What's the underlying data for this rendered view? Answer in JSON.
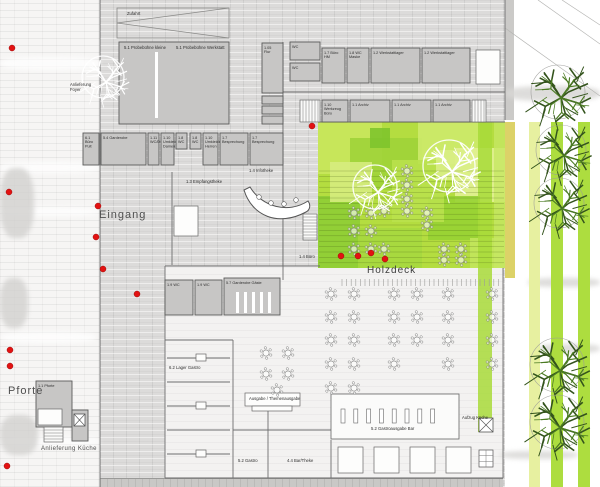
{
  "labels": {
    "eingang": "Eingang",
    "holzdeck": "Holzdeck",
    "pforte": "Pforte",
    "anlieferung_kueche": "Anlieferung Küche"
  },
  "colors": {
    "deck_base": "#b4dd40",
    "stripe_green": "#addd3f",
    "stripe_yellow": "#e7f0a0",
    "stripe_olive": "#d8cd58",
    "red_dot": "#e31212",
    "tree_green": "#33531c",
    "room_fill": "#c7c6c5",
    "wall": "#6e6e6e"
  },
  "rooms": [
    [
      "",
      119,
      42,
      110,
      82
    ],
    [
      "1.05 Flur",
      262,
      43,
      21,
      50
    ],
    [
      "",
      262,
      96,
      21,
      8
    ],
    [
      "",
      262,
      106,
      21,
      8
    ],
    [
      "",
      262,
      116,
      21,
      8
    ],
    [
      "WC",
      290,
      42,
      30,
      18
    ],
    [
      "WC",
      290,
      63,
      30,
      18
    ],
    [
      "1.7 Büro HM",
      322,
      48,
      23,
      35
    ],
    [
      "1.8 WC Maske",
      347,
      48,
      22,
      35
    ],
    [
      "1.2 Werkstattlager",
      371,
      48,
      49,
      35
    ],
    [
      "1.2 Werkstattlager",
      422,
      48,
      48,
      35
    ],
    [
      "1.10 Werkzeug Büro",
      322,
      100,
      26,
      22
    ],
    [
      "1.1 Archiv",
      350,
      100,
      40,
      22
    ],
    [
      "1.1 Archiv",
      392,
      100,
      39,
      22
    ],
    [
      "1.1 Archiv",
      433,
      100,
      37,
      22
    ],
    [
      "6.1 Büro Pult",
      83,
      133,
      16,
      32
    ],
    [
      "5.4 Garderobe",
      101,
      133,
      45,
      32
    ],
    [
      "1.11 WC/Du",
      148,
      133,
      11,
      32
    ],
    [
      "1.10 Umkleide Damen",
      161,
      133,
      13,
      32
    ],
    [
      "1.8 WC",
      176,
      133,
      11,
      16
    ],
    [
      "1.8 WC",
      190,
      133,
      11,
      16
    ],
    [
      "1.10 Umkleide Herren",
      203,
      133,
      15,
      32
    ],
    [
      "1.7 Besprechung",
      220,
      133,
      28,
      32
    ],
    [
      "1.7 Besprechung",
      250,
      133,
      33,
      32
    ],
    [
      "1.9 WC",
      165,
      280,
      28,
      35
    ],
    [
      "1.9 WC",
      195,
      280,
      27,
      35
    ],
    [
      "5.7 Garderobe Gäste",
      224,
      278,
      56,
      37
    ],
    [
      "1.1 Pforte",
      36,
      381,
      36,
      46
    ],
    [
      "",
      72,
      410,
      16,
      31
    ]
  ],
  "tiny_labels": [
    [
      "Zufahrt",
      127,
      15
    ],
    [
      "5.1 Probebühne kleine",
      124,
      49
    ],
    [
      "5.1 Probebühne Werkstatt",
      176,
      49
    ],
    [
      "Anlieferung",
      70,
      86
    ],
    [
      "Foyer",
      70,
      91
    ],
    [
      "1.4 Infotheke",
      249,
      172
    ],
    [
      "1.3 Empfangstheke",
      186,
      183
    ],
    [
      "1.4 Büro",
      299,
      258
    ],
    [
      "Ausgabe / Themenausgabe",
      249,
      400
    ],
    [
      "5.2 Gastroausgabe Bar",
      371,
      430
    ],
    [
      "Aufzug Küche",
      462,
      419
    ],
    [
      "5.2 Gastro",
      238,
      462
    ],
    [
      "4.4 Bar/Theke",
      287,
      462
    ],
    [
      "6.2 Lager Gastro",
      169,
      369
    ]
  ],
  "walls": [
    [
      100,
      0,
      100,
      487
    ],
    [
      283,
      42,
      283,
      280
    ],
    [
      172,
      172,
      172,
      265
    ],
    [
      283,
      92,
      505,
      92
    ],
    [
      318,
      122,
      505,
      122
    ],
    [
      165,
      266,
      320,
      266
    ],
    [
      165,
      266,
      165,
      478
    ],
    [
      233,
      340,
      233,
      478
    ],
    [
      165,
      340,
      233,
      340
    ],
    [
      503,
      268,
      503,
      478
    ],
    [
      165,
      478,
      503,
      478
    ],
    [
      268,
      409,
      268,
      478
    ],
    [
      233,
      430,
      331,
      430
    ],
    [
      331,
      440,
      331,
      478
    ],
    [
      167,
      358,
      230,
      358
    ],
    [
      167,
      382,
      230,
      382
    ],
    [
      167,
      406,
      230,
      406
    ],
    [
      167,
      430,
      230,
      430
    ],
    [
      167,
      454,
      230,
      454
    ],
    [
      505,
      0,
      505,
      120
    ]
  ],
  "white_boxes": [
    [
      174,
      206,
      24,
      30
    ],
    [
      476,
      50,
      24,
      34
    ],
    [
      245,
      393,
      55,
      13
    ],
    [
      252,
      406,
      40,
      5
    ],
    [
      438,
      396,
      13,
      12
    ],
    [
      338,
      447,
      25,
      26
    ],
    [
      374,
      447,
      25,
      26
    ],
    [
      410,
      447,
      25,
      26
    ],
    [
      446,
      447,
      25,
      26
    ],
    [
      196,
      354,
      10,
      7
    ],
    [
      196,
      402,
      10,
      7
    ],
    [
      196,
      450,
      10,
      7
    ],
    [
      38,
      409,
      24,
      16
    ]
  ],
  "slots": [
    [
      236,
      292,
      3,
      21
    ],
    [
      244,
      292,
      3,
      21
    ],
    [
      252,
      292,
      3,
      21
    ],
    [
      260,
      292,
      3,
      21
    ],
    [
      268,
      292,
      3,
      21
    ],
    [
      155,
      52,
      3,
      66
    ]
  ],
  "bar": {
    "x": 331,
    "y": 394,
    "w": 128,
    "h": 45,
    "slot_y": 409,
    "slot_x0": 341,
    "slot_step": 12.8,
    "slot_n": 8,
    "slot_w": 4,
    "slot_h": 14
  },
  "stairs": [
    {
      "x": 303,
      "y": 214,
      "w": 14,
      "h": 26,
      "dir": "h"
    },
    {
      "x": 300,
      "y": 100,
      "w": 20,
      "h": 22,
      "dir": "v"
    },
    {
      "x": 472,
      "y": 100,
      "w": 14,
      "h": 22,
      "dir": "v"
    },
    {
      "x": 44,
      "y": 427,
      "w": 19,
      "h": 15,
      "dir": "h"
    }
  ],
  "x_boxes": [
    [
      74,
      414,
      11,
      12
    ],
    [
      479,
      418,
      14,
      14
    ]
  ],
  "grid_box": [
    479,
    450,
    14,
    17
  ],
  "bench": {
    "path": "M244,190 C252,216 278,227 306,212 C310,210 311,205 308,201 C288,214 262,207 250,187 Z",
    "stools": [
      [
        259,
        197
      ],
      [
        271,
        203
      ],
      [
        284,
        204
      ],
      [
        296,
        200
      ]
    ]
  },
  "trapezoid": {
    "x": 117,
    "y": 8,
    "w": 112,
    "h": 30,
    "apex_y": 23
  },
  "holzdeck_area": {
    "x": 318,
    "y": 122,
    "w": 187,
    "h": 146,
    "patches": [
      [
        318,
        122,
        64,
        52,
        "#c9e75d"
      ],
      [
        350,
        138,
        72,
        52,
        "#9ed338"
      ],
      [
        418,
        122,
        62,
        42,
        "#cdea6c"
      ],
      [
        370,
        128,
        20,
        20,
        "#7ec42c"
      ],
      [
        455,
        148,
        50,
        54,
        "#e2f193"
      ],
      [
        318,
        196,
        42,
        72,
        "#8ecd35"
      ],
      [
        358,
        228,
        64,
        40,
        "#a6d83f"
      ],
      [
        428,
        196,
        52,
        44,
        "#97d133"
      ],
      [
        330,
        162,
        42,
        40,
        "#d6ec7e"
      ],
      [
        470,
        238,
        35,
        30,
        "#c2e55c"
      ],
      [
        392,
        160,
        52,
        62,
        "#b9e14c"
      ],
      [
        436,
        150,
        34,
        30,
        "#d9ee85"
      ]
    ],
    "boards": {
      "y0": 171,
      "y1": 266,
      "step": 5.4
    },
    "ticks": {
      "x0": 342,
      "x1": 503,
      "y0": 279,
      "y1": 286,
      "step": 4.6
    }
  },
  "stripes": [
    [
      478,
      122,
      14,
      310,
      "#a8db3a",
      0.85
    ],
    [
      494,
      122,
      11,
      146,
      "#c6e763",
      0.8
    ],
    [
      505,
      122,
      10,
      156,
      "#d8cd58",
      0.9
    ],
    [
      529,
      122,
      11,
      365,
      "#e7f0a0",
      1
    ],
    [
      551,
      122,
      12,
      365,
      "#addd3f",
      1
    ],
    [
      578,
      122,
      12,
      365,
      "#addd3f",
      1
    ]
  ],
  "tables": {
    "deck": [
      [
        354,
        213
      ],
      [
        371,
        213
      ],
      [
        384,
        211
      ],
      [
        407,
        171
      ],
      [
        407,
        185
      ],
      [
        407,
        199
      ],
      [
        407,
        211
      ],
      [
        427,
        213
      ],
      [
        427,
        225
      ],
      [
        354,
        231
      ],
      [
        371,
        231
      ],
      [
        354,
        249
      ],
      [
        371,
        249
      ],
      [
        384,
        249
      ],
      [
        444,
        249
      ],
      [
        461,
        249
      ],
      [
        444,
        260
      ],
      [
        461,
        260
      ]
    ],
    "hall": [
      [
        331,
        294
      ],
      [
        354,
        294
      ],
      [
        331,
        317
      ],
      [
        354,
        317
      ],
      [
        331,
        340
      ],
      [
        354,
        340
      ],
      [
        331,
        364
      ],
      [
        354,
        364
      ],
      [
        331,
        388
      ],
      [
        354,
        388
      ],
      [
        394,
        294
      ],
      [
        417,
        294
      ],
      [
        394,
        317
      ],
      [
        417,
        317
      ],
      [
        394,
        340
      ],
      [
        417,
        340
      ],
      [
        394,
        364
      ],
      [
        448,
        294
      ],
      [
        448,
        317
      ],
      [
        448,
        340
      ],
      [
        448,
        364
      ],
      [
        492,
        294
      ],
      [
        492,
        317
      ],
      [
        492,
        340
      ],
      [
        492,
        364
      ],
      [
        266,
        353
      ],
      [
        288,
        353
      ],
      [
        266,
        374
      ],
      [
        288,
        374
      ],
      [
        277,
        390
      ]
    ]
  },
  "trees": {
    "white": [
      [
        375,
        187,
        22
      ],
      [
        449,
        166,
        26
      ],
      [
        103,
        77,
        21
      ]
    ],
    "green": [
      [
        558,
        92,
        27
      ],
      [
        561,
        150,
        25
      ],
      [
        559,
        203,
        25
      ],
      [
        557,
        365,
        27
      ],
      [
        557,
        422,
        27
      ]
    ]
  },
  "red_dots": [
    [
      12,
      48
    ],
    [
      9,
      192
    ],
    [
      98,
      206
    ],
    [
      96,
      237
    ],
    [
      103,
      269
    ],
    [
      137,
      294
    ],
    [
      10,
      350
    ],
    [
      10,
      366
    ],
    [
      7,
      466
    ],
    [
      341,
      256
    ],
    [
      358,
      256
    ],
    [
      371,
      253
    ],
    [
      385,
      259
    ],
    [
      312,
      126
    ]
  ],
  "persp_lines": [
    [
      505,
      28,
      600,
      96
    ],
    [
      538,
      0,
      600,
      44
    ],
    [
      562,
      0,
      600,
      25
    ]
  ],
  "streaks": {
    "white_left": [
      [
        0,
        57,
        100,
        13
      ],
      [
        0,
        162,
        100,
        11
      ],
      [
        0,
        207,
        100,
        9
      ],
      [
        0,
        332,
        96,
        11
      ],
      [
        0,
        437,
        100,
        9
      ]
    ],
    "gray_left": [
      [
        0,
        168,
        34,
        70
      ],
      [
        0,
        278,
        28,
        50
      ],
      [
        0,
        415,
        38,
        40
      ]
    ],
    "gray_right": [
      [
        505,
        86,
        95,
        15
      ],
      [
        528,
        278,
        72,
        9
      ],
      [
        538,
        344,
        62,
        9
      ],
      [
        500,
        451,
        78,
        8
      ]
    ]
  }
}
